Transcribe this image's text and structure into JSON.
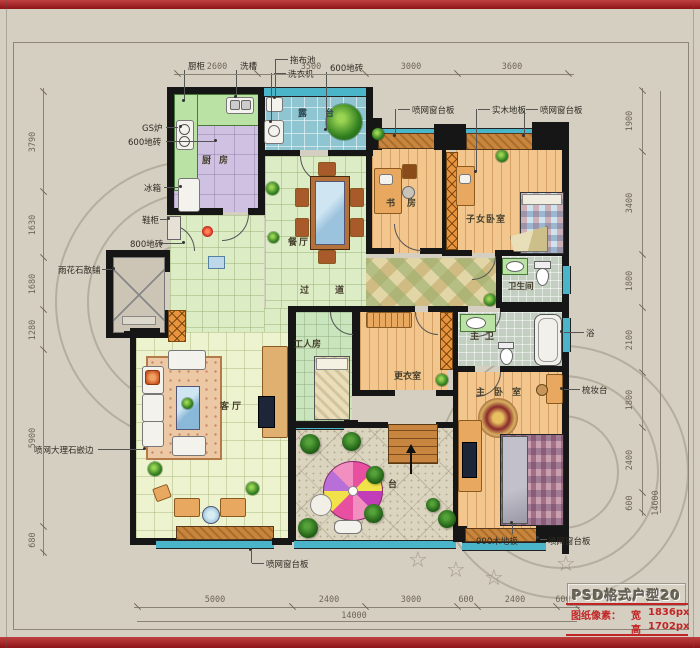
{
  "dims": {
    "top": [
      "2600",
      "3500",
      "3000",
      "3600"
    ],
    "left": [
      "3790",
      "1630",
      "1680",
      "1280",
      "5900",
      "680"
    ],
    "right": [
      "1900",
      "3400",
      "1800",
      "2100",
      "1800",
      "2400",
      "600"
    ],
    "right_total": "14600",
    "bottom": [
      "5000",
      "2400",
      "3000",
      "600",
      "2400",
      "600"
    ],
    "bottom_total": "14000"
  },
  "rooms": {
    "kitchen": "厨房",
    "laundry_balcony": "露台",
    "dining": "餐厅",
    "corridor": "过道",
    "study": "书房",
    "kids_bedroom": "子女卧室",
    "bathroom": "卫生间",
    "master_bath": "主卫",
    "master_bedroom": "主卧室",
    "dressing_room": "更衣室",
    "worker_room": "工人房",
    "living_room": "客厅",
    "terrace": "台"
  },
  "annotations": {
    "cabinet": "厨柜",
    "sink": "洗槽",
    "mop_pool": "拖布池",
    "washing_machine": "洗衣机",
    "tile_600_top": "600地砖",
    "sill_top_left": "喷网窗台板",
    "solid_wood_floor": "实木地板",
    "sill_top_right": "喷网窗台板",
    "gas_stove": "GS炉",
    "tile_600_left": "600地砖",
    "fridge": "冰箱",
    "shoe_cabinet": "鞋柜",
    "tile_800": "800地砖",
    "rain_stone": "雨花石散铺",
    "marble_edge": "喷网大理石嵌边",
    "bath": "浴",
    "dresser": "梳妆台",
    "wood_900": "900木地板",
    "sill_bottom_right": "喷网窗台板",
    "sill_bottom_left": "喷网窗台板"
  },
  "title_block": {
    "title": "PSD格式户型20",
    "pixels_label": "图纸像素：",
    "width_label": "宽",
    "width_value": "1836px",
    "height_label": "高",
    "height_value": "1702px"
  },
  "colors": {
    "accent_red": "#a21d22",
    "wall": "#161616",
    "window_teal": "#4ab5c9",
    "sill_orange": "#c9853c"
  }
}
